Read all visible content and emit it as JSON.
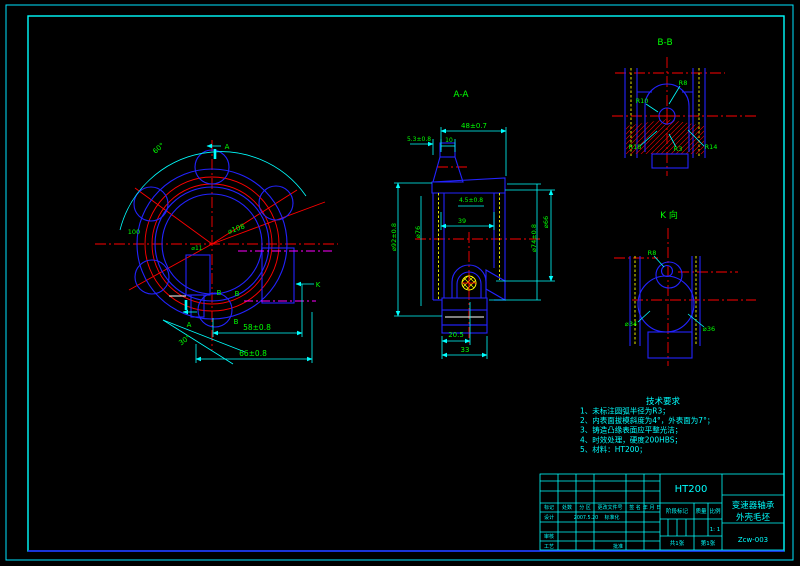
{
  "drawing_title": "变速器轴承外壳毛坯",
  "colors": {
    "background": "#000000",
    "geometry_blue": "#2323ff",
    "centerline_red": "#ff0000",
    "hatch_yellow": "#ffff00",
    "dimension_green": "#00ff00",
    "dimension_line_cyan": "#00ffff",
    "phantom_magenta": "#ff00ff"
  },
  "views": {
    "front": {
      "labels": [
        {
          "t": "60°",
          "x": 160,
          "y": 150,
          "r": -40,
          "n": "angle-60"
        },
        {
          "t": "A",
          "x": 227,
          "y": 149,
          "n": "section-arrow-a-top"
        },
        {
          "t": "⌀108",
          "x": 237,
          "y": 231,
          "r": -20,
          "n": "dim-d108"
        },
        {
          "t": "100",
          "x": 134,
          "y": 234,
          "s": 6.5,
          "n": "dim-100"
        },
        {
          "t": "⌀11",
          "x": 197,
          "y": 250,
          "s": 6,
          "n": "dim-d11"
        },
        {
          "t": "B",
          "x": 219,
          "y": 295,
          "n": "label-b-1"
        },
        {
          "t": "B",
          "x": 237,
          "y": 296,
          "n": "label-b-2"
        },
        {
          "t": "B",
          "x": 236,
          "y": 324,
          "n": "label-b-3"
        },
        {
          "t": "K",
          "x": 318,
          "y": 287,
          "n": "view-arrow-k"
        },
        {
          "t": "A",
          "x": 189,
          "y": 327,
          "n": "section-arrow-a-bottom"
        },
        {
          "t": "30°",
          "x": 186,
          "y": 342,
          "r": -35,
          "n": "angle-30"
        },
        {
          "t": "58±0.8",
          "x": 257,
          "y": 330,
          "s": 7.5,
          "n": "dim-58"
        },
        {
          "t": "66±0.8",
          "x": 253,
          "y": 356,
          "s": 7.5,
          "n": "dim-66"
        }
      ]
    },
    "section_aa": {
      "labels": [
        {
          "t": "A-A",
          "x": 461,
          "y": 97,
          "s": 9,
          "n": "section-title-aa"
        },
        {
          "t": "48±0.7",
          "x": 474,
          "y": 128,
          "s": 7,
          "n": "dim-48"
        },
        {
          "t": "5.3±0.8",
          "x": 419,
          "y": 141,
          "s": 6,
          "n": "dim-5-3"
        },
        {
          "t": "10",
          "x": 449,
          "y": 142,
          "s": 6,
          "n": "dim-10"
        },
        {
          "t": "4.5±0.8",
          "x": 471,
          "y": 202,
          "s": 6,
          "n": "dim-4-5"
        },
        {
          "t": "39",
          "x": 462,
          "y": 223,
          "s": 6.5,
          "n": "dim-39"
        },
        {
          "t": "⌀92±0.8",
          "x": 396,
          "y": 237,
          "r": -90,
          "s": 6.5,
          "n": "dim-d92"
        },
        {
          "t": "⌀76",
          "x": 420,
          "y": 232,
          "r": -90,
          "s": 6.5,
          "n": "dim-d76"
        },
        {
          "t": "⌀66",
          "x": 548,
          "y": 222,
          "r": -90,
          "s": 6.5,
          "n": "dim-d66"
        },
        {
          "t": "⌀74±0.8",
          "x": 536,
          "y": 238,
          "r": -90,
          "s": 6.5,
          "n": "dim-d74"
        },
        {
          "t": "20.5",
          "x": 456,
          "y": 337,
          "s": 7,
          "n": "dim-20-5"
        },
        {
          "t": "33",
          "x": 465,
          "y": 352,
          "s": 7,
          "n": "dim-33"
        }
      ]
    },
    "section_bb": {
      "labels": [
        {
          "t": "B-B",
          "x": 665,
          "y": 45,
          "s": 9,
          "n": "section-title-bb"
        },
        {
          "t": "R8",
          "x": 683,
          "y": 85,
          "s": 6.5,
          "n": "dim-r8"
        },
        {
          "t": "R10",
          "x": 642,
          "y": 103,
          "s": 6.5,
          "n": "dim-r10"
        },
        {
          "t": "R18",
          "x": 635,
          "y": 149,
          "s": 6.5,
          "n": "dim-r18"
        },
        {
          "t": "R3",
          "x": 678,
          "y": 151,
          "s": 6.5,
          "n": "dim-r3"
        },
        {
          "t": "R14",
          "x": 711,
          "y": 149,
          "s": 6.5,
          "n": "dim-r14"
        }
      ]
    },
    "view_k": {
      "labels": [
        {
          "t": "K 向",
          "x": 669,
          "y": 218,
          "s": 9,
          "n": "view-title-k"
        },
        {
          "t": "R8",
          "x": 652,
          "y": 255,
          "s": 6.5,
          "n": "dim-r8-k"
        },
        {
          "t": "⌀34",
          "x": 631,
          "y": 326,
          "s": 6.5,
          "n": "dim-d34"
        },
        {
          "t": "⌀36",
          "x": 709,
          "y": 331,
          "s": 6.5,
          "n": "dim-d36"
        }
      ]
    }
  },
  "technical_requirements": {
    "title": "技术要求",
    "items": [
      "1、未标注圆弧半径为R3；",
      "2、内表面拔模斜度为4°，外表面为7°；",
      "3、铸造凸缘表面应平整光洁；",
      "4、时效处理，硬度200HBS；",
      "5、材料：HT200；"
    ]
  },
  "title_block": {
    "material": "HT200",
    "part_name": [
      "变速器轴承",
      "外壳毛坯"
    ],
    "drawing_number": "Zcw-003",
    "scale": "1: 1",
    "design_date": "2007.5.20",
    "labels": [
      {
        "t": "HT200",
        "x": 691,
        "y": 492,
        "s": 10,
        "n": "material"
      },
      {
        "t": "变速器轴承",
        "x": 753,
        "y": 508,
        "s": 8.5,
        "n": "part-name-line1"
      },
      {
        "t": "外壳毛坯",
        "x": 753,
        "y": 520,
        "s": 8.5,
        "n": "part-name-line2"
      },
      {
        "t": "Zcw-003",
        "x": 753,
        "y": 542,
        "s": 7,
        "n": "drawing-number"
      },
      {
        "t": "阶段标记",
        "x": 677,
        "y": 513,
        "s": 5.5,
        "n": "stage-mark-label"
      },
      {
        "t": "质量",
        "x": 701,
        "y": 513,
        "s": 5.5,
        "n": "mass-label"
      },
      {
        "t": "比例",
        "x": 715,
        "y": 513,
        "s": 5.5,
        "n": "scale-label"
      },
      {
        "t": "1: 1",
        "x": 715,
        "y": 531,
        "s": 5.5,
        "n": "scale-value"
      },
      {
        "t": "共1张",
        "x": 677,
        "y": 545,
        "s": 5.5,
        "n": "sheet-total"
      },
      {
        "t": "第1张",
        "x": 708,
        "y": 545,
        "s": 5.5,
        "n": "sheet-number"
      },
      {
        "t": "标记",
        "x": 549,
        "y": 509,
        "s": 5,
        "n": "col-mark"
      },
      {
        "t": "处数",
        "x": 567,
        "y": 509,
        "s": 5,
        "n": "col-count"
      },
      {
        "t": "分 区",
        "x": 585,
        "y": 509,
        "s": 5,
        "n": "col-zone"
      },
      {
        "t": "更改文件号",
        "x": 610,
        "y": 509,
        "s": 5,
        "n": "col-change-file"
      },
      {
        "t": "签 名",
        "x": 635,
        "y": 509,
        "s": 5,
        "n": "col-signature"
      },
      {
        "t": "年 月 日",
        "x": 652,
        "y": 509,
        "s": 5,
        "n": "col-date"
      },
      {
        "t": "设计",
        "x": 549,
        "y": 519,
        "s": 5,
        "n": "row-design"
      },
      {
        "t": "2007.5.20",
        "x": 586,
        "y": 519,
        "s": 4.8,
        "n": "design-date"
      },
      {
        "t": "标准化",
        "x": 612,
        "y": 519,
        "s": 5,
        "n": "row-standardization"
      },
      {
        "t": "审核",
        "x": 549,
        "y": 538,
        "s": 5,
        "n": "row-audit"
      },
      {
        "t": "工艺",
        "x": 549,
        "y": 548,
        "s": 5,
        "n": "row-process"
      },
      {
        "t": "批准",
        "x": 618,
        "y": 548,
        "s": 5,
        "n": "row-approve"
      }
    ]
  }
}
